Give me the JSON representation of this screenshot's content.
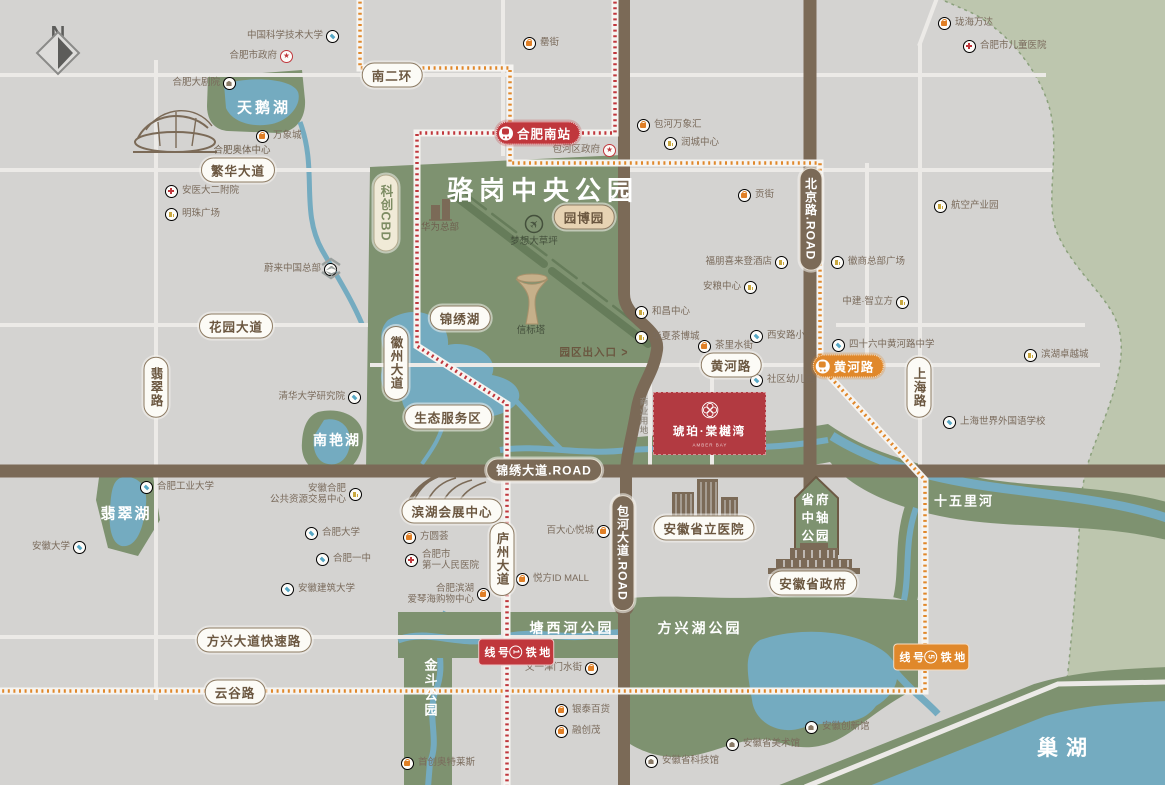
{
  "title": "琥珀·棠樾湾 区位图",
  "compass": {
    "label": "N"
  },
  "project": {
    "block_label": "琥珀·棠樾湾",
    "block_sub": "AMBER BAY",
    "land_use": "商业用地"
  },
  "colors": {
    "land": "#d4d3d1",
    "park": "#7e9270",
    "sage": "#bdc6ae",
    "water": "#74abc0",
    "road_white": "#eceae7",
    "road_brown": "#7b6a57",
    "metro_line1_red": "#c0373c",
    "metro_line5_orange": "#e0882b",
    "badge_text": "#6b5740",
    "poi_text": "#7a6b5c",
    "mall_orange": "#e07f26",
    "office_gold": "#c9a83f",
    "school_blue": "#56a7c5",
    "hospital_red": "#c0373c",
    "museum_brown": "#8a7a66",
    "project_red": "#b23a41"
  },
  "shield": {
    "lines": [
      "省府",
      "中轴",
      "公园"
    ],
    "x": 816,
    "y": 518
  },
  "park_labels": [
    {
      "label": "骆岗中央公园",
      "x": 543,
      "y": 189,
      "size": 26,
      "ls": 6
    },
    {
      "label": "天鹅湖",
      "x": 264,
      "y": 107,
      "size": 15,
      "ls": 3
    },
    {
      "label": "南艳湖",
      "x": 337,
      "y": 440,
      "size": 14,
      "ls": 2
    },
    {
      "label": "翡翠湖",
      "x": 126,
      "y": 513,
      "size": 15,
      "ls": 2
    },
    {
      "label": "塘西河公园",
      "x": 572,
      "y": 628,
      "size": 14,
      "ls": 3
    },
    {
      "label": "方兴湖公园",
      "x": 700,
      "y": 628,
      "size": 14,
      "ls": 3
    },
    {
      "label": "金斗公园",
      "x": 430,
      "y": 688,
      "size": 13,
      "ls": 2,
      "vertical": true
    },
    {
      "label": "十五里河",
      "x": 964,
      "y": 500,
      "size": 13,
      "ls": 2
    },
    {
      "label": "巢湖",
      "x": 1066,
      "y": 747,
      "size": 21,
      "ls": 8
    }
  ],
  "badges": [
    {
      "label": "南二环",
      "x": 392,
      "y": 75,
      "variant": "white"
    },
    {
      "label": "繁华大道",
      "x": 238,
      "y": 170,
      "variant": "white"
    },
    {
      "label": "花园大道",
      "x": 236,
      "y": 326,
      "variant": "white"
    },
    {
      "label": "翡翠路",
      "x": 156,
      "y": 387,
      "variant": "white",
      "vertical": true
    },
    {
      "label": "徽州大道",
      "x": 396,
      "y": 363,
      "variant": "white",
      "vertical": true
    },
    {
      "label": "锦绣湖",
      "x": 460,
      "y": 318,
      "variant": "white"
    },
    {
      "label": "生态服务区",
      "x": 448,
      "y": 417,
      "variant": "white"
    },
    {
      "label": "园博园",
      "x": 584,
      "y": 217,
      "variant": "tan"
    },
    {
      "label": "科创CBD",
      "x": 386,
      "y": 213,
      "variant": "sage",
      "vertical": true
    },
    {
      "label": "黄河路",
      "x": 731,
      "y": 365,
      "variant": "white"
    },
    {
      "label": "上海路",
      "x": 919,
      "y": 387,
      "variant": "white",
      "vertical": true
    },
    {
      "label": "锦绣大道.ROAD",
      "x": 544,
      "y": 470,
      "variant": "brown"
    },
    {
      "label": "北京路.ROAD",
      "x": 811,
      "y": 219,
      "variant": "brown",
      "vertical": true
    },
    {
      "label": "包河大道.ROAD",
      "x": 623,
      "y": 553,
      "variant": "brown",
      "vertical": true
    },
    {
      "label": "庐州大道",
      "x": 502,
      "y": 559,
      "variant": "white",
      "vertical": true
    },
    {
      "label": "滨湖会展中心",
      "x": 452,
      "y": 511,
      "variant": "white"
    },
    {
      "label": "安徽省立医院",
      "x": 704,
      "y": 528,
      "variant": "white"
    },
    {
      "label": "安徽省政府",
      "x": 813,
      "y": 583,
      "variant": "white"
    },
    {
      "label": "方兴大道快速路",
      "x": 254,
      "y": 640,
      "variant": "white"
    },
    {
      "label": "云谷路",
      "x": 235,
      "y": 692,
      "variant": "white"
    },
    {
      "label": "合肥南站",
      "x": 538,
      "y": 133,
      "variant": "station-red"
    },
    {
      "label": "黄河路",
      "x": 848,
      "y": 366,
      "variant": "station-orange"
    },
    {
      "label": "地铁1号线",
      "x": 516,
      "y": 652,
      "variant": "metro-red",
      "vertical": true
    },
    {
      "label": "地铁5号线",
      "x": 931,
      "y": 657,
      "variant": "metro-orange",
      "vertical": true
    }
  ],
  "landmarks": [
    {
      "label": "合肥奥体中心",
      "x": 242,
      "y": 149,
      "cls": "brown"
    },
    {
      "label": "华为总部",
      "x": 440,
      "y": 226,
      "cls": "brown"
    },
    {
      "label": "梦想大草坪",
      "x": 534,
      "y": 240,
      "cls": "olive"
    },
    {
      "label": "信标塔",
      "x": 531,
      "y": 329,
      "cls": "olive"
    },
    {
      "label": "园区出入口",
      "x": 594,
      "y": 352,
      "cls": "brown-bold",
      "arrow": ">"
    },
    {
      "label": "商业用地",
      "x": 644,
      "y": 416,
      "cls": "gray",
      "vertical": true
    }
  ],
  "pois": [
    {
      "label": "中国科学技术大学",
      "x": 333,
      "y": 37,
      "type": "edu",
      "side": "right"
    },
    {
      "label": "合肥市政府",
      "x": 287,
      "y": 57,
      "type": "gov",
      "side": "right"
    },
    {
      "label": "合肥大剧院",
      "x": 230,
      "y": 84,
      "type": "museum",
      "side": "right"
    },
    {
      "label": "万象城",
      "x": 263,
      "y": 137,
      "type": "mall",
      "side": "left"
    },
    {
      "label": "安医大二附院",
      "x": 172,
      "y": 192,
      "type": "hosp",
      "side": "left"
    },
    {
      "label": "明珠广场",
      "x": 172,
      "y": 215,
      "type": "biz",
      "side": "left"
    },
    {
      "label": "蔚来中国总部",
      "x": 331,
      "y": 270,
      "type": "nio",
      "side": "right"
    },
    {
      "label": "清华大学研究院",
      "x": 355,
      "y": 398,
      "type": "edu",
      "side": "right"
    },
    {
      "label": "合肥工业大学",
      "x": 147,
      "y": 488,
      "type": "edu",
      "side": "left"
    },
    {
      "label": "安徽合肥",
      "label2": "公共资源交易中心",
      "x": 356,
      "y": 495,
      "type": "biz",
      "side": "right"
    },
    {
      "label": "安徽大学",
      "x": 80,
      "y": 548,
      "type": "edu",
      "side": "right"
    },
    {
      "label": "合肥大学",
      "x": 312,
      "y": 534,
      "type": "edu",
      "side": "left"
    },
    {
      "label": "合肥一中",
      "x": 323,
      "y": 560,
      "type": "edu",
      "side": "left"
    },
    {
      "label": "安徽建筑大学",
      "x": 288,
      "y": 590,
      "type": "edu",
      "side": "left"
    },
    {
      "label": "罍街",
      "x": 530,
      "y": 44,
      "type": "mall",
      "side": "left"
    },
    {
      "label": "包河区政府",
      "x": 610,
      "y": 151,
      "type": "gov",
      "side": "right"
    },
    {
      "label": "包河万象汇",
      "x": 644,
      "y": 126,
      "type": "mall",
      "side": "left"
    },
    {
      "label": "润城中心",
      "x": 671,
      "y": 144,
      "type": "biz",
      "side": "left"
    },
    {
      "label": "珑海万达",
      "x": 945,
      "y": 24,
      "type": "mall",
      "side": "left"
    },
    {
      "label": "合肥市儿童医院",
      "x": 970,
      "y": 47,
      "type": "hosp",
      "side": "left"
    },
    {
      "label": "贡街",
      "x": 745,
      "y": 196,
      "type": "mall",
      "side": "left"
    },
    {
      "label": "航空产业园",
      "x": 941,
      "y": 207,
      "type": "biz",
      "side": "left"
    },
    {
      "label": "徽商总部广场",
      "x": 838,
      "y": 263,
      "type": "biz",
      "side": "left"
    },
    {
      "label": "福朋喜来登酒店",
      "x": 782,
      "y": 263,
      "type": "biz",
      "side": "right"
    },
    {
      "label": "安粮中心",
      "x": 751,
      "y": 288,
      "type": "biz",
      "side": "right"
    },
    {
      "label": "中建·智立方",
      "x": 903,
      "y": 303,
      "type": "biz",
      "side": "right"
    },
    {
      "label": "和昌中心",
      "x": 642,
      "y": 313,
      "type": "biz",
      "side": "left"
    },
    {
      "label": "华夏茶博城",
      "x": 642,
      "y": 338,
      "type": "biz",
      "side": "left"
    },
    {
      "label": "茶里水街",
      "x": 705,
      "y": 347,
      "type": "mall",
      "side": "left"
    },
    {
      "label": "西安路小学",
      "x": 757,
      "y": 337,
      "type": "edu",
      "side": "left"
    },
    {
      "label": "四十六中黄河路中学",
      "x": 839,
      "y": 346,
      "type": "edu",
      "side": "left"
    },
    {
      "label": "社区幼儿园",
      "x": 757,
      "y": 381,
      "type": "edu",
      "side": "left"
    },
    {
      "label": "滨湖卓越城",
      "x": 1031,
      "y": 356,
      "type": "biz",
      "side": "left"
    },
    {
      "label": "上海世界外国语学校",
      "x": 950,
      "y": 423,
      "type": "edu",
      "side": "left"
    },
    {
      "label": "方圆荟",
      "x": 410,
      "y": 538,
      "type": "mall",
      "side": "left"
    },
    {
      "label": "合肥市",
      "label2": "第一人民医院",
      "x": 412,
      "y": 561,
      "type": "hosp",
      "side": "left"
    },
    {
      "label": "合肥滨湖",
      "label2": "爱琴海购物中心",
      "x": 484,
      "y": 595,
      "type": "mall",
      "side": "right"
    },
    {
      "label": "百大心悦城",
      "x": 604,
      "y": 532,
      "type": "mall",
      "side": "right"
    },
    {
      "label": "悦方ID MALL",
      "x": 523,
      "y": 580,
      "type": "mall",
      "side": "left"
    },
    {
      "label": "文一津门水街",
      "x": 592,
      "y": 669,
      "type": "mall",
      "side": "right"
    },
    {
      "label": "银泰百货",
      "x": 562,
      "y": 711,
      "type": "mall",
      "side": "left"
    },
    {
      "label": "融创茂",
      "x": 562,
      "y": 732,
      "type": "mall",
      "side": "left"
    },
    {
      "label": "首创奥特莱斯",
      "x": 408,
      "y": 764,
      "type": "mall",
      "side": "left"
    },
    {
      "label": "安徽省科技馆",
      "x": 652,
      "y": 762,
      "type": "museum",
      "side": "left"
    },
    {
      "label": "安徽省美术馆",
      "x": 733,
      "y": 745,
      "type": "museum",
      "side": "left"
    },
    {
      "label": "安徽创新馆",
      "x": 812,
      "y": 728,
      "type": "museum",
      "side": "left"
    }
  ]
}
